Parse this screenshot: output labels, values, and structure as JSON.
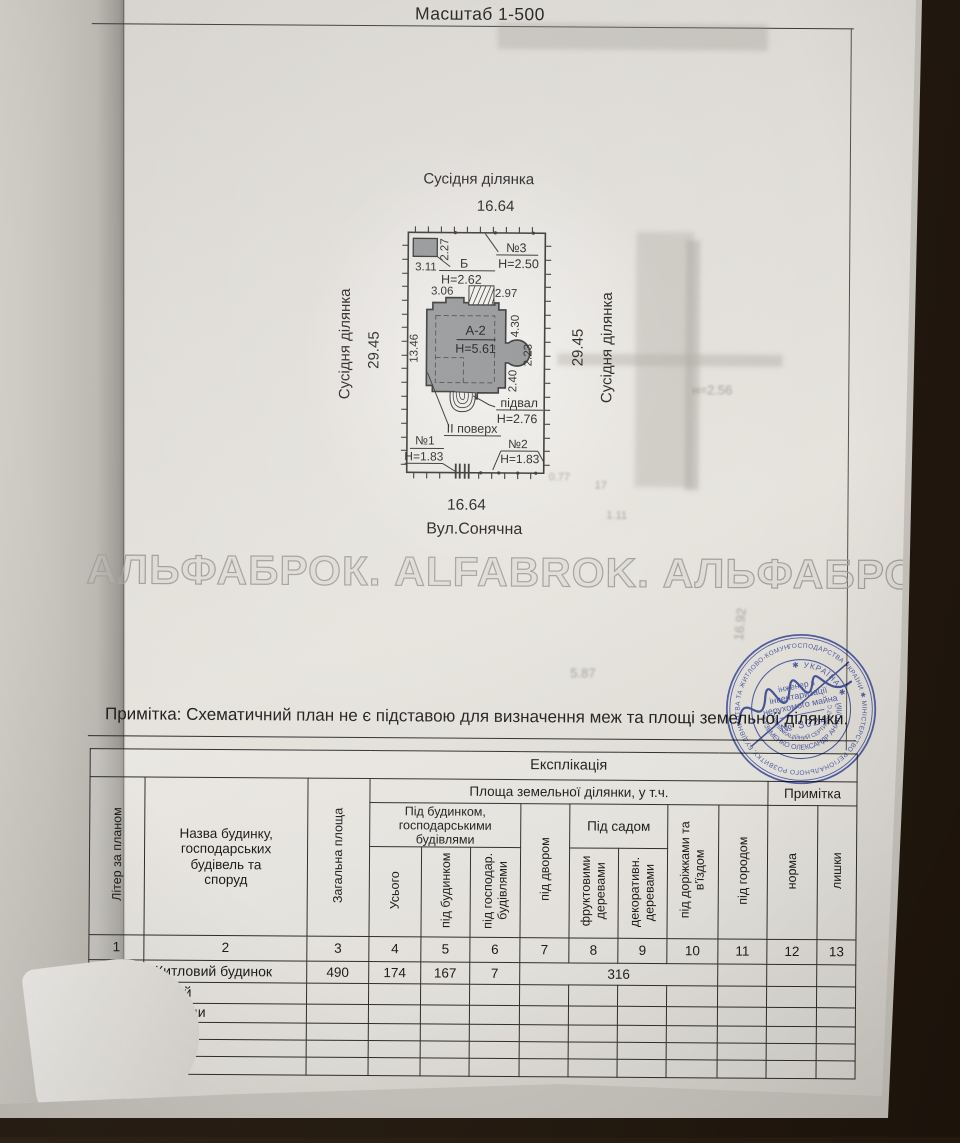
{
  "header": {
    "scale_label": "Масштаб 1-500"
  },
  "site_plan": {
    "top_neighbor_label": "Сусідня ділянка",
    "top_width": "16.64",
    "left_neighbor_label": "Сусідня ділянка",
    "left_length": "29.45",
    "right_length": "29.45",
    "right_neighbor_label": "Сусідня ділянка",
    "bottom_width": "16.64",
    "street_label": "Вул.Сонячна",
    "main_building": {
      "litera": "А-2",
      "height": "Н=5.61"
    },
    "basement": {
      "label": "підвал",
      "height": "Н=2.76"
    },
    "second_floor_label": "ІІ поверх",
    "shed": {
      "litera": "Б",
      "height": "Н=2.62",
      "dim_w": "3.11",
      "dim_d": "2.27"
    },
    "structure1": {
      "label": "№1",
      "height": "Н=1.83"
    },
    "structure2": {
      "label": "№2",
      "height": "Н=1.83"
    },
    "structure3": {
      "label": "№3",
      "height": "Н=2.50"
    },
    "dims": {
      "top_left": "3.06",
      "top_right": "2.97",
      "right_upper": "4.30",
      "right_bay": "2.23",
      "right_lower": "2.40",
      "left_side": "13.46"
    }
  },
  "watermark": "АЛЬФАБРОК. ALFABROK. АЛЬФАБРОК",
  "note": "Примітка: Схематичний план не є підставою для визначення меж та площі земельної ділянки.",
  "ghost_texts": {
    "g1": "н=2.56",
    "g2": "16.92",
    "g3": "5.87",
    "g4": "0.77",
    "g5": "17",
    "g6": "1.11"
  },
  "stamp": {
    "ring_outer": "ГОСПОДАРСТВА УКРАЇНИ ✱ МІНІСТЕРСТВО РЕГІОНАЛЬНОГО РОЗВИТКУ, БУДІВНИЦТВА ТА ЖИТЛОВО-КОМУНАЛЬНОГО ГОСПОДАРСТВА ✱ АТЕСТАЦІЙНА АРХІТЕКТУРНО-БУДІВЕЛЬНА КОМІСІЯ ✱",
    "country": "✱ УКРАЇНА ✱",
    "name_ring": "КУЗЬМЕНКО ОЛЕКСАНДР АНАТОЛІЙОВИЧ",
    "cert_ring": "КВАЛІФІКАЦІЙНИЙ СЕРТИФІКАТ СЕРІЯ АБ",
    "center_line1": "інженер з",
    "center_line2": "інвентаризації",
    "center_line3": "нерухомого майна",
    "number": "№ 3024",
    "color": "#3c4a96"
  },
  "table": {
    "title": "Експлікація",
    "area_group": "Площа  земельної ділянки, у т.ч.",
    "note_col": "Примітка",
    "col_liter": "Літер за планом",
    "col_name": "Назва будинку,\nгосподарських\nбудівель та\nспоруд",
    "col_total_area": "Загальна площа",
    "group_under_building": "Під будинком,\nгосподарськими\nбудівлями",
    "col_usogo": "Усього",
    "col_under_house": "під будинком",
    "col_under_household": "під господар.\nбудівлями",
    "col_yard": "під двором",
    "group_garden": "Під садом",
    "col_fruit_trees": "фруктовими\nдеревами",
    "col_decor_trees": "декоративн.\nдеревами",
    "col_paths": "під доріжками та\nв'їздом",
    "col_vegetable": "під городом",
    "col_norm": "норма",
    "col_surplus": "лишки",
    "numbers": [
      "1",
      "2",
      "3",
      "4",
      "5",
      "6",
      "7",
      "8",
      "9",
      "10",
      "11",
      "12",
      "13"
    ],
    "rows": [
      {
        "liter": "А-2",
        "name": "Житловий будинок",
        "total": "490",
        "usogo": "174",
        "house": "167",
        "household": "7",
        "merged": "316"
      },
      {
        "liter": "Б",
        "name": "Сарай"
      },
      {
        "liter": "№1-3",
        "name": "Споруди"
      }
    ]
  }
}
